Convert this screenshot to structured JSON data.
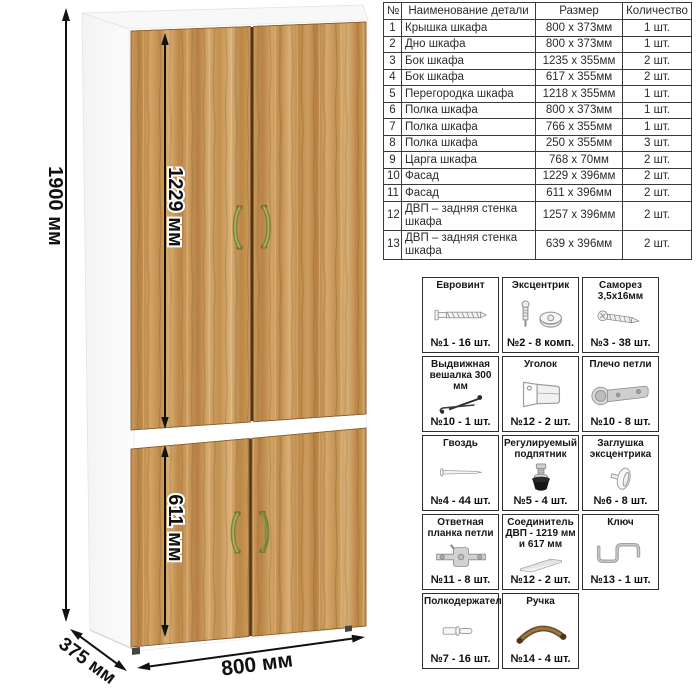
{
  "wardrobe": {
    "dim_height": "1900 мм",
    "dim_upper_door": "1229 мм",
    "dim_lower_door": "611 мм",
    "dim_width": "800 мм",
    "dim_depth": "375 мм",
    "colors": {
      "wood": "#c79759",
      "wood_dark": "#9a6b33",
      "handle_olive": "#7f823a",
      "handle_bronze": "#6e4f28",
      "carcass_white": "#ffffff",
      "dimension_line": "#111111"
    }
  },
  "parts_table": {
    "headers": {
      "num": "№",
      "name": "Наименование детали",
      "size": "Размер",
      "qty": "Количество"
    },
    "rows": [
      {
        "num": "1",
        "name": "Крышка шкафа",
        "size": "800 х 373мм",
        "qty": "1 шт."
      },
      {
        "num": "2",
        "name": "Дно шкафа",
        "size": "800 х 373мм",
        "qty": "1 шт."
      },
      {
        "num": "3",
        "name": "Бок шкафа",
        "size": "1235 х 355мм",
        "qty": "2 шт."
      },
      {
        "num": "4",
        "name": "Бок шкафа",
        "size": "617 х 355мм",
        "qty": "2 шт."
      },
      {
        "num": "5",
        "name": "Перегородка шкафа",
        "size": "1218 х 355мм",
        "qty": "1 шт."
      },
      {
        "num": "6",
        "name": "Полка шкафа",
        "size": "800 х 373мм",
        "qty": "1 шт."
      },
      {
        "num": "7",
        "name": "Полка шкафа",
        "size": "766 х 355мм",
        "qty": "1 шт."
      },
      {
        "num": "8",
        "name": "Полка шкафа",
        "size": "250 х 355мм",
        "qty": "3 шт."
      },
      {
        "num": "9",
        "name": "Царга шкафа",
        "size": "768 х 70мм",
        "qty": "2 шт."
      },
      {
        "num": "10",
        "name": "Фасад",
        "size": "1229 х 396мм",
        "qty": "2 шт."
      },
      {
        "num": "11",
        "name": "Фасад",
        "size": "611 х 396мм",
        "qty": "2 шт."
      },
      {
        "num": "12",
        "name": "ДВП – задняя стенка шкафа",
        "size": "1257 х 396мм",
        "qty": "2 шт."
      },
      {
        "num": "13",
        "name": "ДВП – задняя стенка шкафа",
        "size": "639 х 396мм",
        "qty": "2 шт."
      }
    ]
  },
  "hardware_items": [
    {
      "title": "Евровинт",
      "count": "№1 - 16 шт.",
      "icon": "confirmat-screw-icon"
    },
    {
      "title": "Эксцентрик",
      "count": "№2 - 8 комп.",
      "icon": "cam-lock-icon"
    },
    {
      "title": "Саморез 3,5х16мм",
      "count": "№3 - 38 шт.",
      "icon": "tapping-screw-icon"
    },
    {
      "title": "Выдвижная вешалка 300 мм",
      "count": "№10 - 1 шт.",
      "icon": "pullout-hanger-icon"
    },
    {
      "title": "Уголок",
      "count": "№12 - 2 шт.",
      "icon": "corner-bracket-icon"
    },
    {
      "title": "Плечо петли",
      "count": "№10 - 8 шт.",
      "icon": "hinge-arm-icon"
    },
    {
      "title": "Гвоздь",
      "count": "№4 - 44 шт.",
      "icon": "nail-icon"
    },
    {
      "title": "Регулируемый подпятник",
      "count": "№5 - 4 шт.",
      "icon": "adjustable-foot-icon"
    },
    {
      "title": "Заглушка эксцентрика",
      "count": "№6 - 8 шт.",
      "icon": "cam-plug-icon"
    },
    {
      "title": "Ответная планка петли",
      "count": "№11 - 8 шт.",
      "icon": "hinge-plate-icon"
    },
    {
      "title": "Соединитель ДВП - 1219 мм и 617 мм",
      "count": "№12 - 2 шт.",
      "icon": "hdf-connector-icon"
    },
    {
      "title": "Ключ",
      "count": "№13 - 1 шт.",
      "icon": "key-icon"
    },
    {
      "title": "Полкодержатель",
      "count": "№7 - 16 шт.",
      "icon": "shelf-pin-icon"
    },
    {
      "title": "Ручка",
      "count": "№14 - 4 шт.",
      "icon": "handle-icon"
    }
  ]
}
